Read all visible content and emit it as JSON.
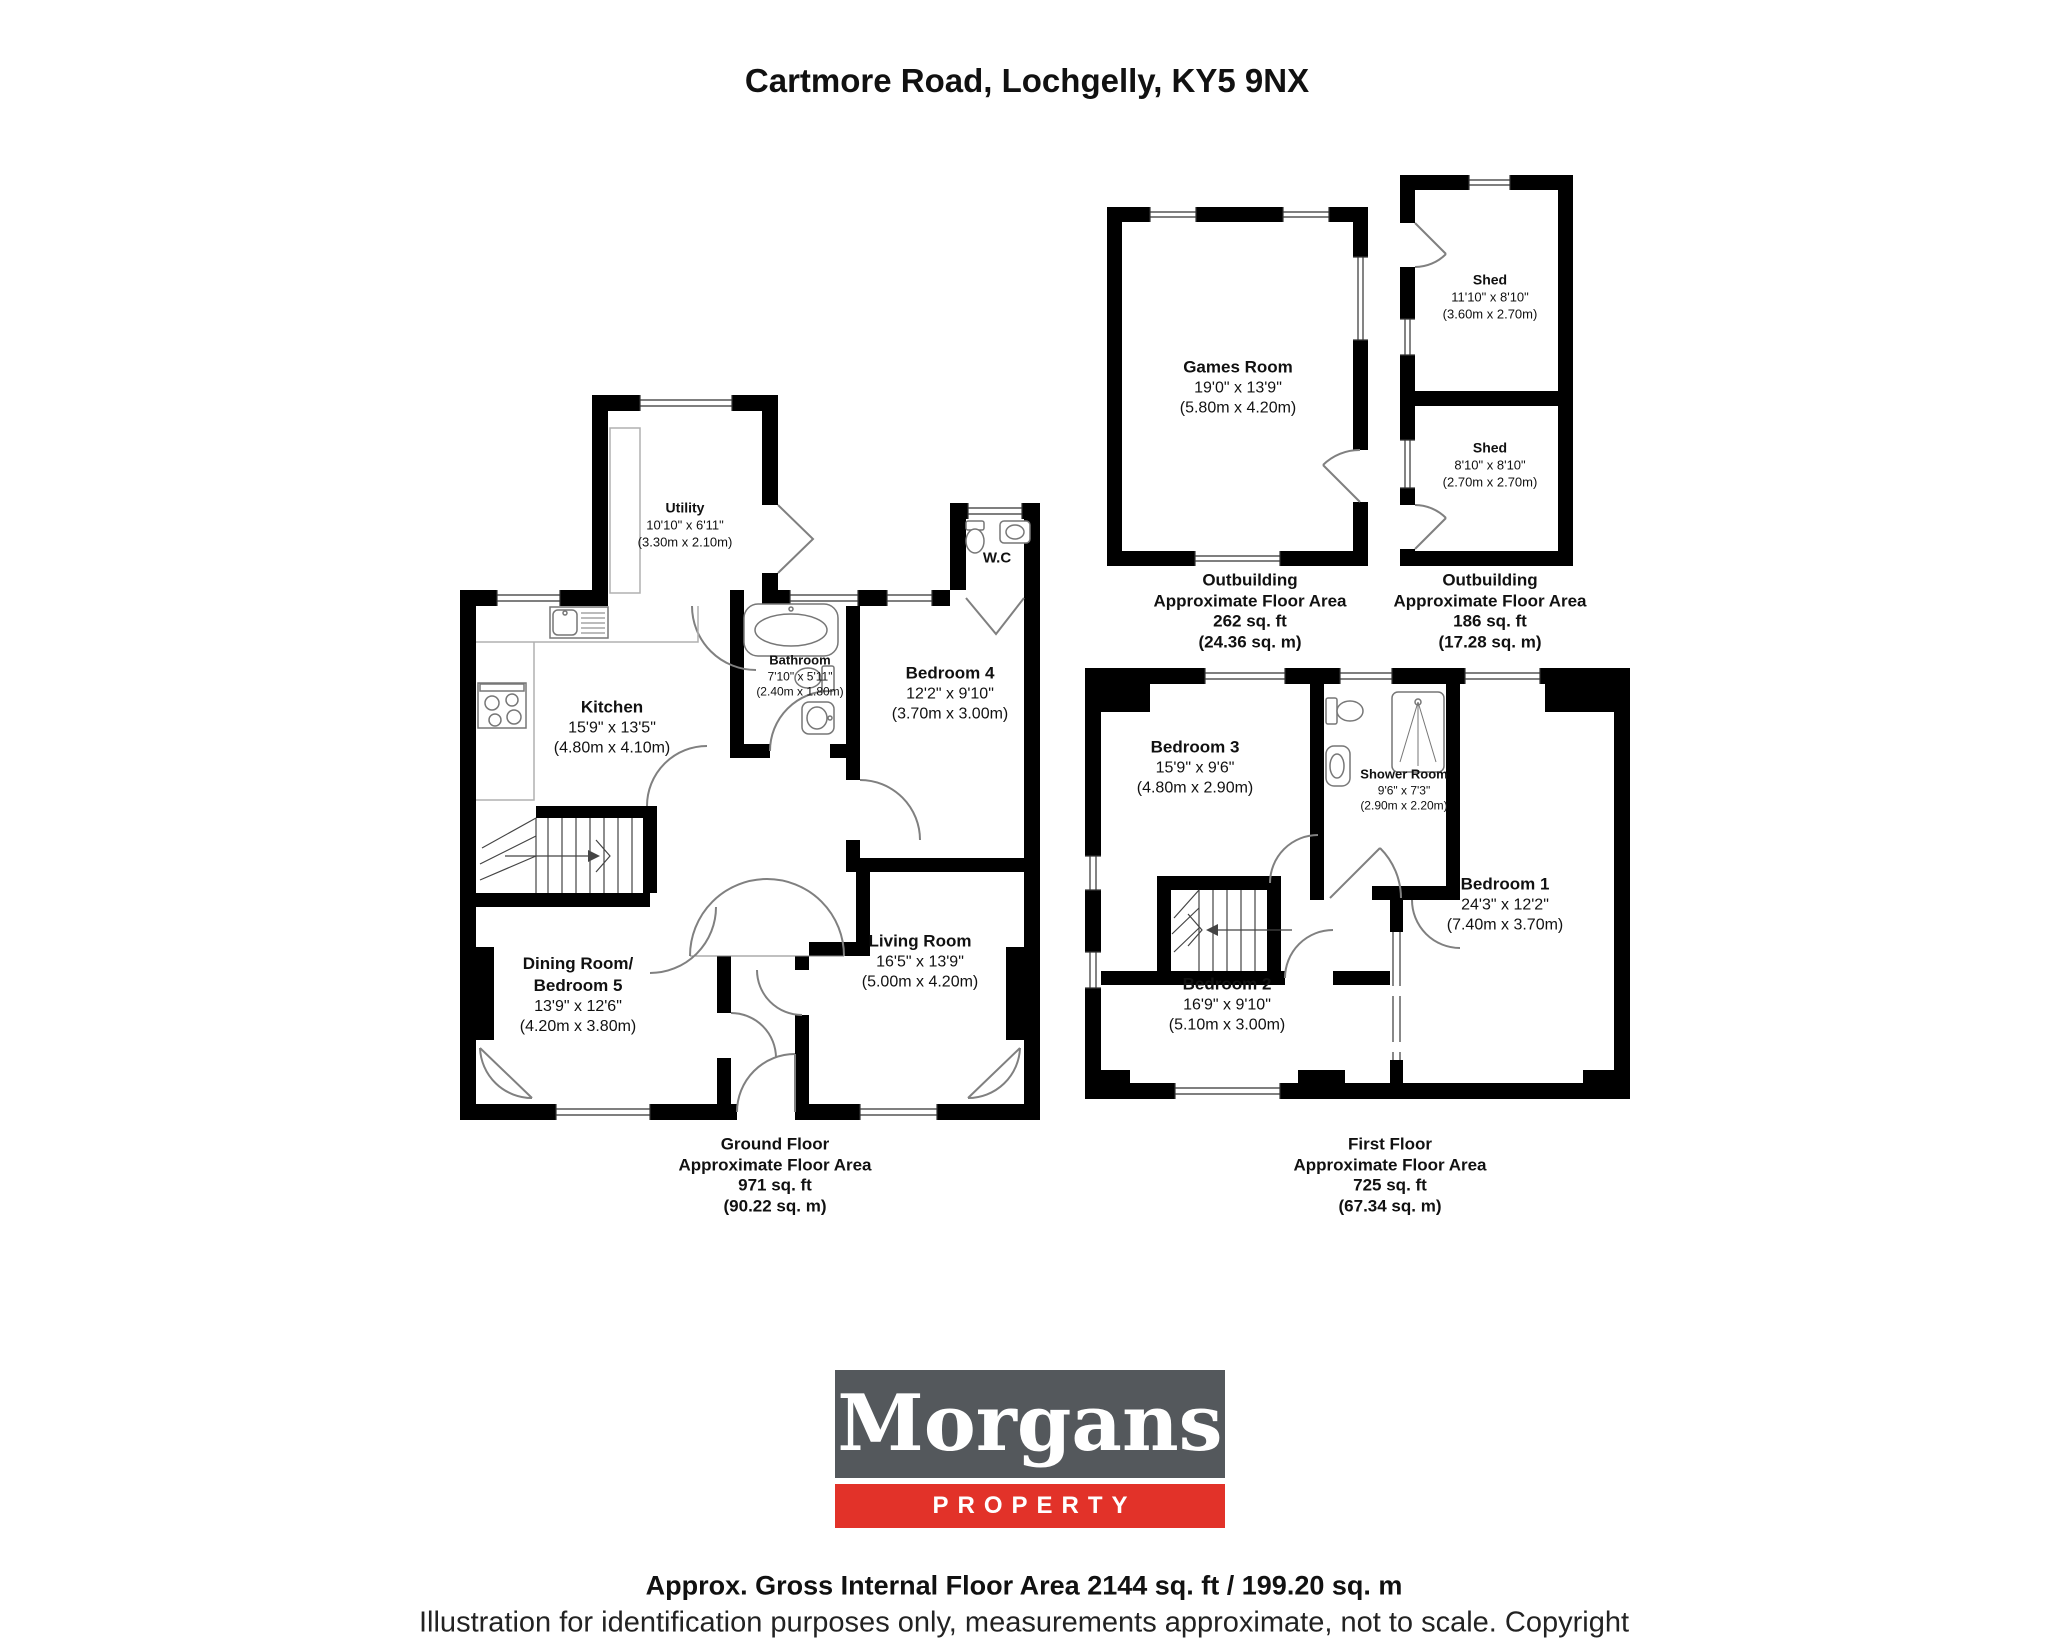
{
  "title": "Cartmore Road, Lochgelly, KY5 9NX",
  "outbuildings": {
    "games_room": {
      "name": "Games Room",
      "imperial": "19'0\" x 13'9\"",
      "metric": "(5.80m x 4.20m)"
    },
    "shed_large": {
      "name": "Shed",
      "imperial": "11'10\" x 8'10\"",
      "metric": "(3.60m x 2.70m)"
    },
    "shed_small": {
      "name": "Shed",
      "imperial": "8'10\" x 8'10\"",
      "metric": "(2.70m x 2.70m)"
    },
    "area_left": {
      "title": "Outbuilding",
      "subtitle": "Approximate Floor Area",
      "sqft": "262 sq. ft",
      "sqm": "(24.36 sq. m)"
    },
    "area_right": {
      "title": "Outbuilding",
      "subtitle": "Approximate Floor Area",
      "sqft": "186 sq. ft",
      "sqm": "(17.28 sq. m)"
    }
  },
  "ground_floor": {
    "utility": {
      "name": "Utility",
      "imperial": "10'10\" x 6'11\"",
      "metric": "(3.30m x 2.10m)"
    },
    "kitchen": {
      "name": "Kitchen",
      "imperial": "15'9\" x 13'5\"",
      "metric": "(4.80m x 4.10m)"
    },
    "bathroom": {
      "name": "Bathroom",
      "imperial": "7'10\" x 5'11\"",
      "metric": "(2.40m x 1.80m)"
    },
    "wc": {
      "name": "W.C"
    },
    "bedroom4": {
      "name": "Bedroom 4",
      "imperial": "12'2\" x 9'10\"",
      "metric": "(3.70m x 3.00m)"
    },
    "dining": {
      "name1": "Dining Room/",
      "name2": "Bedroom 5",
      "imperial": "13'9\" x 12'6\"",
      "metric": "(4.20m x 3.80m)"
    },
    "living": {
      "name": "Living Room",
      "imperial": "16'5\" x 13'9\"",
      "metric": "(5.00m x 4.20m)"
    },
    "area": {
      "title": "Ground Floor",
      "subtitle": "Approximate Floor Area",
      "sqft": "971 sq. ft",
      "sqm": "(90.22 sq. m)"
    }
  },
  "first_floor": {
    "bedroom3": {
      "name": "Bedroom 3",
      "imperial": "15'9\" x 9'6\"",
      "metric": "(4.80m x 2.90m)"
    },
    "shower": {
      "name": "Shower Room",
      "imperial": "9'6\" x 7'3\"",
      "metric": "(2.90m x 2.20m)"
    },
    "bedroom1": {
      "name": "Bedroom 1",
      "imperial": "24'3\" x 12'2\"",
      "metric": "(7.40m x 3.70m)"
    },
    "bedroom2": {
      "name": "Bedroom 2",
      "imperial": "16'9\" x 9'10\"",
      "metric": "(5.10m x 3.00m)"
    },
    "area": {
      "title": "First Floor",
      "subtitle": "Approximate Floor Area",
      "sqft": "725 sq. ft",
      "sqm": "(67.34 sq. m)"
    }
  },
  "logo": {
    "brand": "Morgans",
    "tagline": "PROPERTY",
    "brand_bg": "#54585c",
    "tagline_bg": "#e23229"
  },
  "footer": {
    "area_line": "Approx. Gross Internal Floor Area 2144 sq. ft / 199.20 sq. m",
    "disclaimer": "Illustration for identification purposes only, measurements approximate, not to scale. Copyright"
  }
}
